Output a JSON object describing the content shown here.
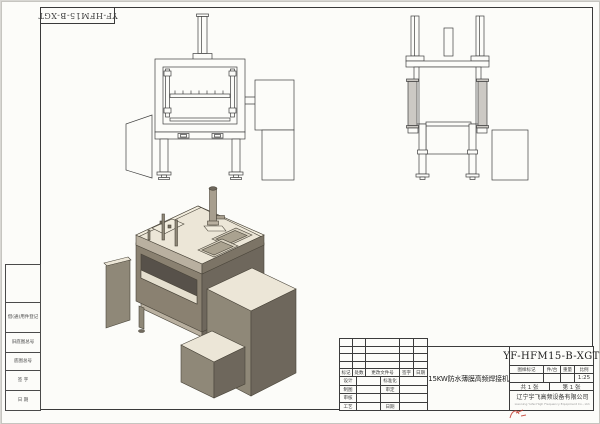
{
  "sheet": {
    "corner_label": "YF-HFM15-B-XGT",
    "binding_fields": [
      "借(通)用件登记",
      "旧底图总号",
      "底图总号",
      "签 字",
      "日 期"
    ]
  },
  "title_block": {
    "drawing_number": "YF-HFM15-B-XGT",
    "product_title": "15KW防水薄膜高频焊接机",
    "revision_cols": [
      "标记",
      "处数",
      "更改文件号",
      "签字",
      "日期"
    ],
    "sign_rows": [
      {
        "left": "设计",
        "right": "标准化"
      },
      {
        "left": "制图",
        "right": "审定"
      },
      {
        "left": "审核",
        "right": ""
      },
      {
        "left": "工艺",
        "right": "日期"
      }
    ],
    "attr_headers": [
      "图样标记",
      "件/台",
      "重量",
      "比例"
    ],
    "scale": "1:25",
    "sheet_total": "共 1 张",
    "sheet_number": "第 1 张",
    "company": "辽宁宇飞高频设备有限公司",
    "company_en": "Liaoning Yufei High Frequency Equipment Co., Ltd."
  },
  "colors": {
    "paper": "#fcfcf9",
    "line": "#3a3a3a",
    "iso_top": "#ece6d7",
    "iso_left": "#8f8878",
    "iso_right": "#6e675c",
    "logo_red": "#c0392b",
    "logo_blue": "#1a3f8f"
  }
}
